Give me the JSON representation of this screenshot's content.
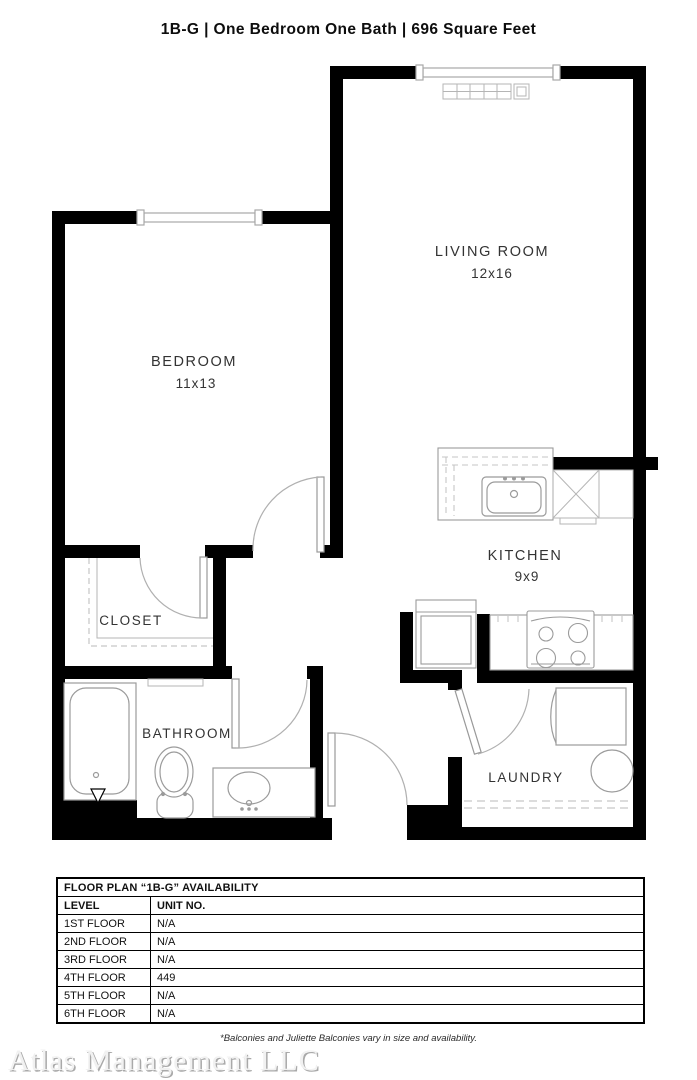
{
  "title": "1B-G | One Bedroom One Bath | 696 Square Feet",
  "rooms": {
    "living_room": {
      "label": "LIVING ROOM",
      "dims": "12x16"
    },
    "bedroom": {
      "label": "BEDROOM",
      "dims": "11x13"
    },
    "kitchen": {
      "label": "KITCHEN",
      "dims": "9x9"
    },
    "closet": {
      "label": "CLOSET"
    },
    "bathroom": {
      "label": "BATHROOM"
    },
    "laundry": {
      "label": "LAUNDRY"
    }
  },
  "availability_table": {
    "title": "FLOOR PLAN “1B-G” AVAILABILITY",
    "columns": [
      "LEVEL",
      "UNIT NO."
    ],
    "rows": [
      [
        "1ST FLOOR",
        "N/A"
      ],
      [
        "2ND FLOOR",
        "N/A"
      ],
      [
        "3RD FLOOR",
        "N/A"
      ],
      [
        "4TH FLOOR",
        "449"
      ],
      [
        "5TH FLOOR",
        "N/A"
      ],
      [
        "6TH FLOOR",
        "N/A"
      ]
    ]
  },
  "footnote": "*Balconies and Juliette Balconies vary in size and availability.",
  "watermark": "Atlas Management LLC",
  "colors": {
    "wall": "#000000",
    "fixture_line": "#9b9b9b",
    "dashed_line": "#c6c6c6",
    "label_text": "#333333",
    "watermark_text": "#f1f1f1"
  }
}
